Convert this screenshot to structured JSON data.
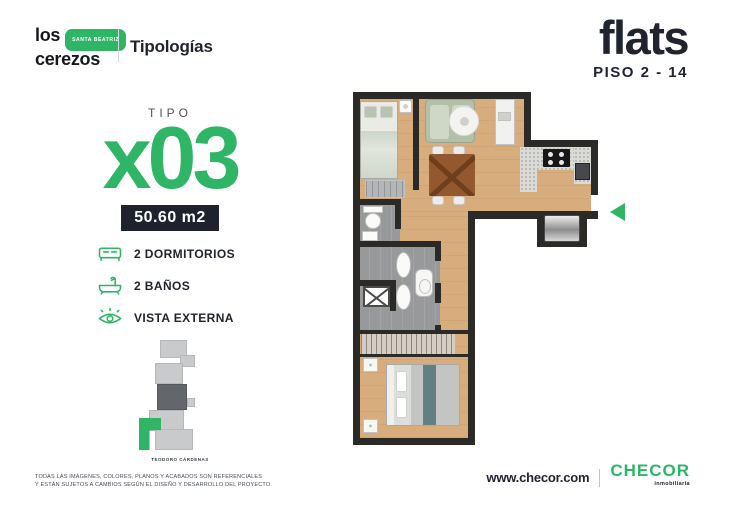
{
  "header": {
    "logo_line1": "los",
    "logo_line2": "cerezos",
    "logo_badge": "SANTA BEATRIZ",
    "section_title": "Tipologías"
  },
  "plan_header": {
    "title": "flats",
    "subtitle": "PISO 2 - 14"
  },
  "unit": {
    "tipo_label": "TIPO",
    "code": "x03",
    "area": "50.60 m2",
    "features": [
      {
        "icon": "bed-icon",
        "label": "2 DORMITORIOS"
      },
      {
        "icon": "bathtub-icon",
        "label": "2 BAÑOS"
      },
      {
        "icon": "eye-icon",
        "label": "VISTA EXTERNA"
      }
    ],
    "site_plan_caption": "TEODORO CÁRDENAS"
  },
  "footer": {
    "disclaimer_line1": "TODAS LAS IMÁGENES, COLORES, PLANOS Y ACABADOS SON REFERENCIALES",
    "disclaimer_line2": "Y ESTÁN SUJETOS A CAMBIOS SEGÚN EL DISEÑO Y DESARROLLO DEL PROYECTO.",
    "website": "www.checor.com",
    "brand": "CHECOR",
    "brand_tagline": "inmobiliaria"
  },
  "colors": {
    "accent_green": "#2EB566",
    "dark_navy": "#1E2430",
    "wall": "#2C2A27",
    "wood_floor": "#D7AD7E",
    "bath_floor": "#97999B"
  }
}
